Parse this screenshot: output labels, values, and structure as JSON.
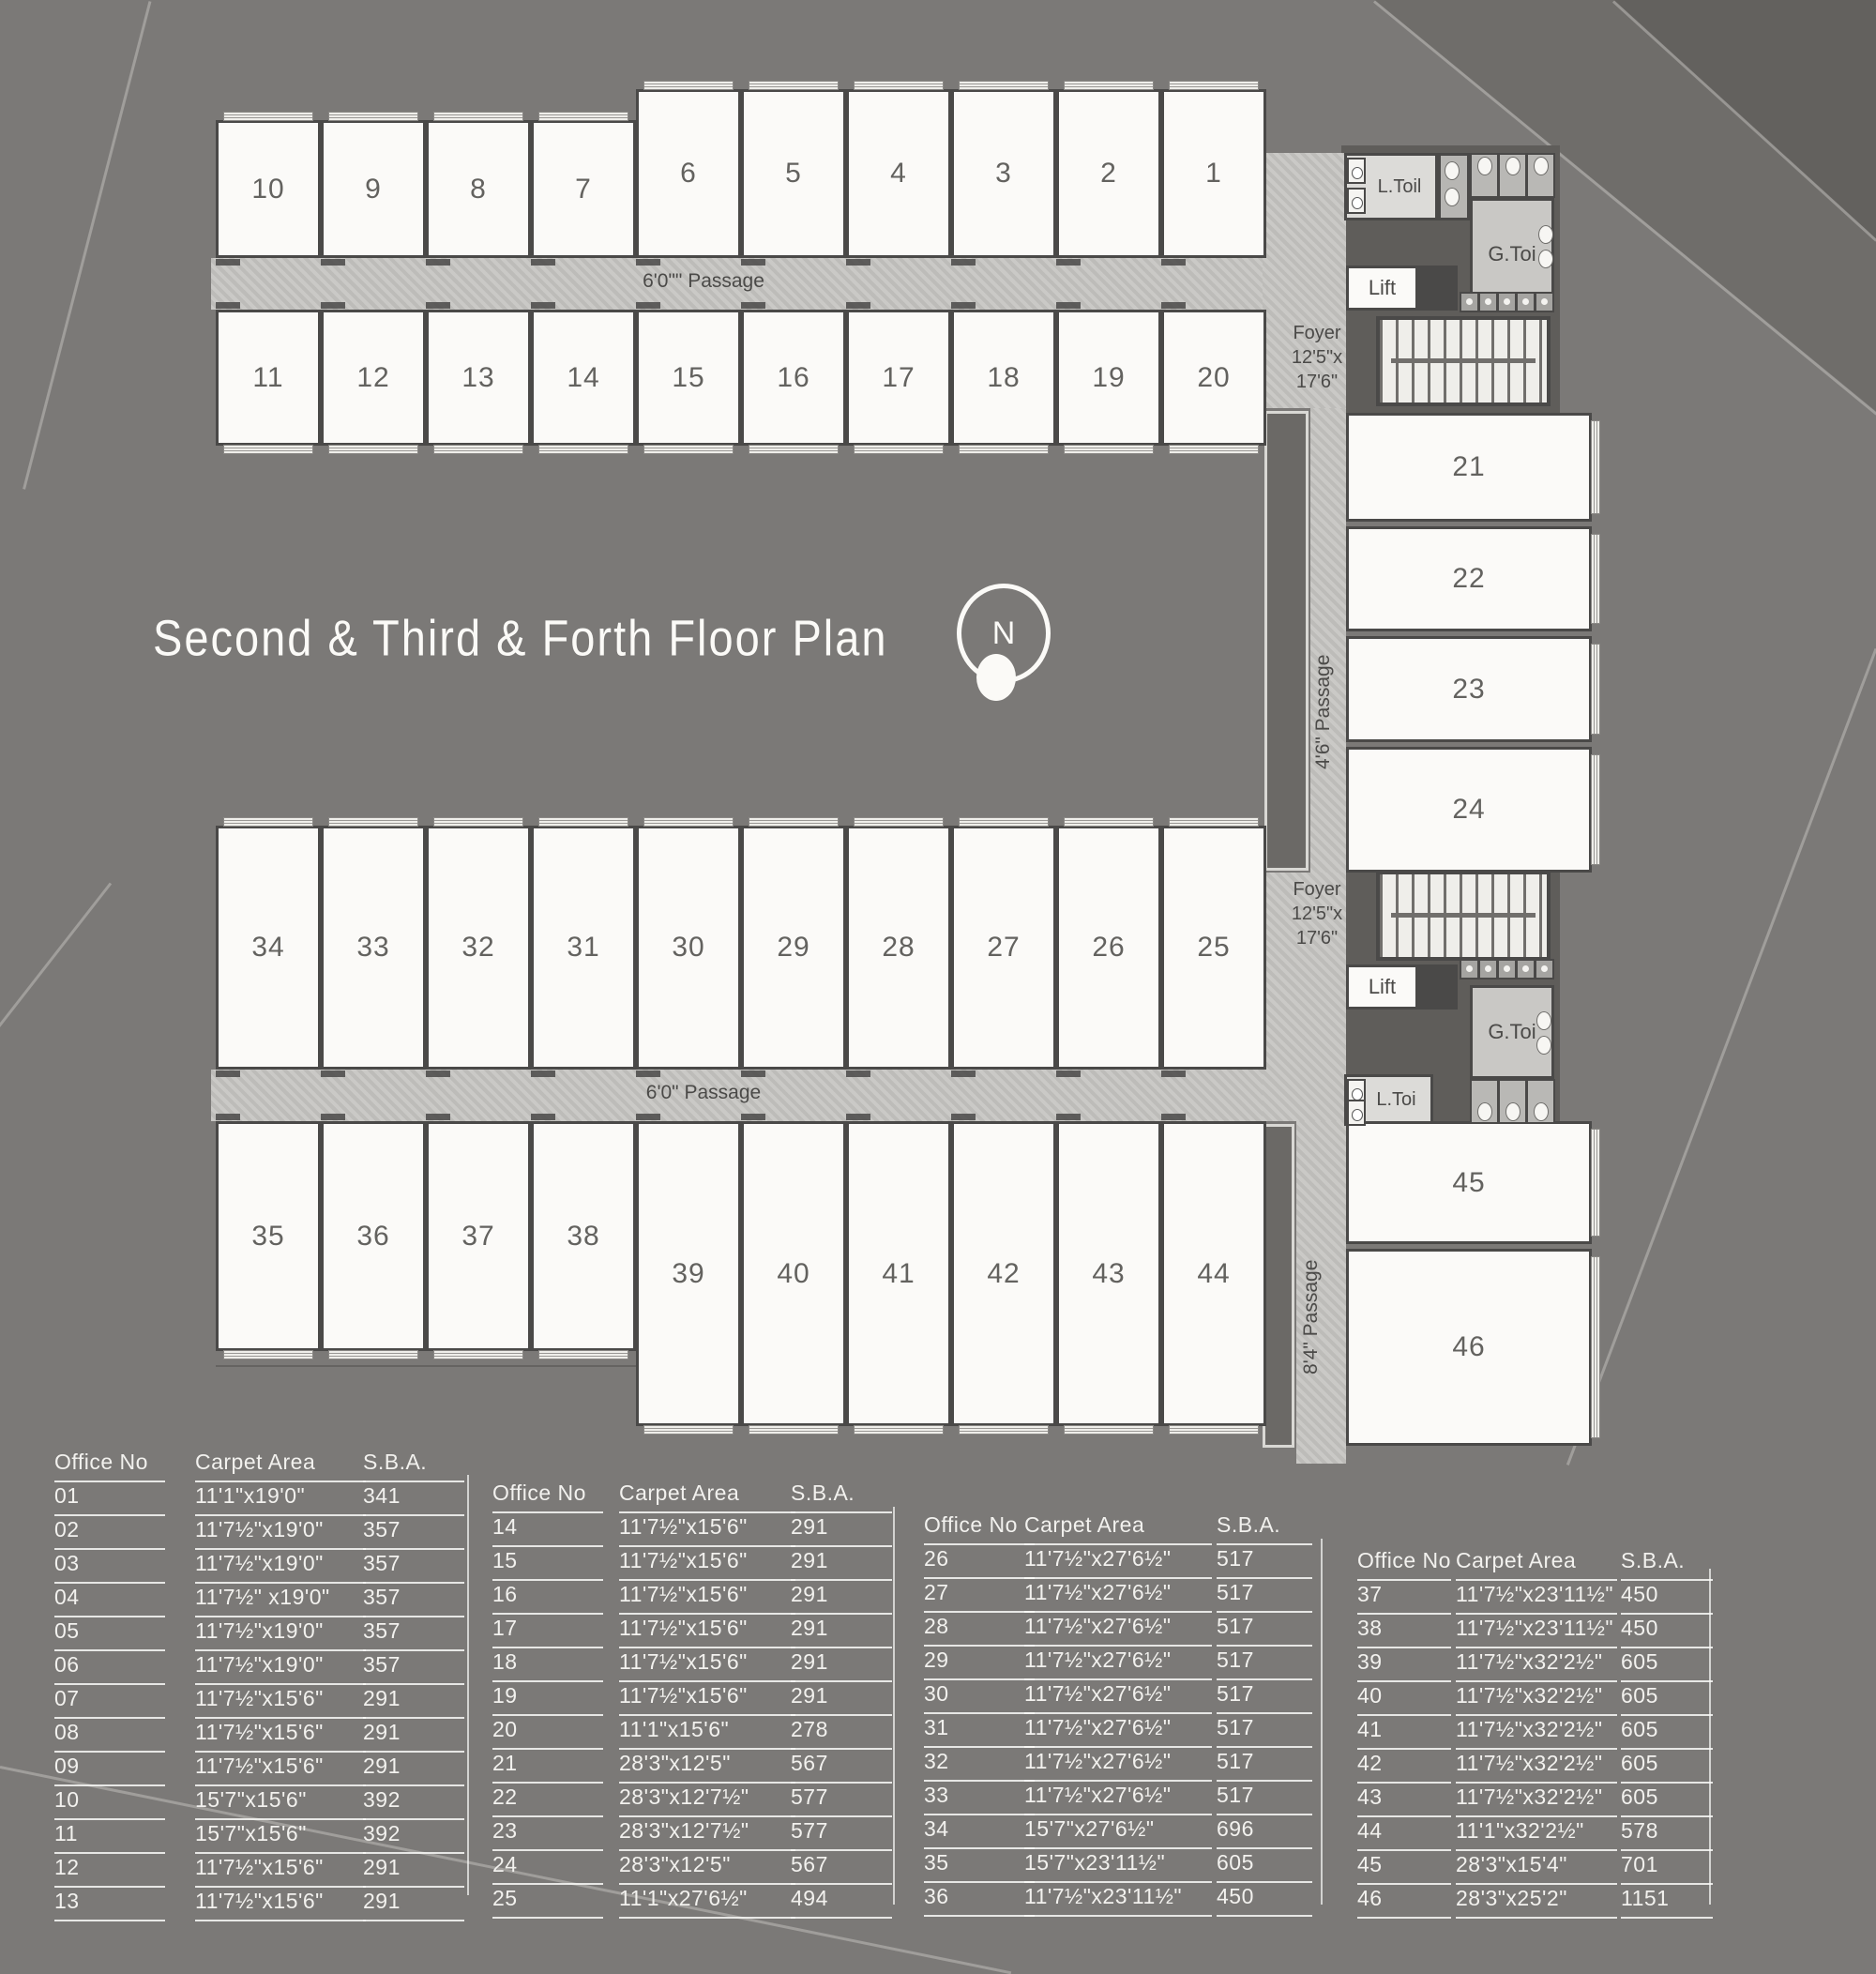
{
  "title": "Second & Third & Forth Floor Plan",
  "compass": {
    "letter": "N"
  },
  "plan": {
    "units": {
      "row_top_a": [
        "10",
        "9",
        "8",
        "7",
        "6",
        "5",
        "4",
        "3",
        "2",
        "1"
      ],
      "row_top_b": [
        "11",
        "12",
        "13",
        "14",
        "15",
        "16",
        "17",
        "18",
        "19",
        "20"
      ],
      "col_right_top": [
        "21",
        "22",
        "23",
        "24"
      ],
      "row_mid_a": [
        "34",
        "33",
        "32",
        "31",
        "30",
        "29",
        "28",
        "27",
        "26",
        "25"
      ],
      "row_mid_b": [
        "35",
        "36",
        "37",
        "38",
        "39",
        "40",
        "41",
        "42",
        "43",
        "44"
      ],
      "col_right_bottom": [
        "45",
        "46"
      ]
    },
    "passages": {
      "top": "6'0\"\" Passage",
      "middle": "6'0\" Passage",
      "right_upper": "4'6\" Passage",
      "right_lower": "8'4\" Passage"
    },
    "foyer_top": {
      "line1": "Foyer",
      "line2": "12'5\"x",
      "line3": "17'6\""
    },
    "foyer_mid": {
      "line1": "Foyer",
      "line2": "12'5\"x",
      "line3": "17'6\""
    },
    "rooms": {
      "ladies_toilet_top": "L.Toil",
      "gents_toilet_top": "G.Toi",
      "lift_top": "Lift",
      "lift_mid": "Lift",
      "gents_toilet_mid": "G.Toi",
      "ladies_toilet_mid": "L.Toi"
    }
  },
  "tables": [
    {
      "headers": [
        "Office No",
        "Carpet Area",
        "S.B.A."
      ],
      "rows": [
        [
          "01",
          "11'1\"x19'0\"",
          "341"
        ],
        [
          "02",
          "11'7½\"x19'0\"",
          "357"
        ],
        [
          "03",
          "11'7½\"x19'0\"",
          "357"
        ],
        [
          "04",
          "11'7½\" x19'0\"",
          "357"
        ],
        [
          "05",
          "11'7½\"x19'0\"",
          "357"
        ],
        [
          "06",
          "11'7½\"x19'0\"",
          "357"
        ],
        [
          "07",
          "11'7½\"x15'6\"",
          "291"
        ],
        [
          "08",
          "11'7½\"x15'6\"",
          "291"
        ],
        [
          "09",
          "11'7½\"x15'6\"",
          "291"
        ],
        [
          "10",
          "15'7\"x15'6\"",
          "392"
        ],
        [
          "11",
          "15'7\"x15'6\"",
          "392"
        ],
        [
          "12",
          "11'7½\"x15'6\"",
          "291"
        ],
        [
          "13",
          "11'7½\"x15'6\"",
          "291"
        ]
      ]
    },
    {
      "headers": [
        "Office No",
        "Carpet Area",
        "S.B.A."
      ],
      "rows": [
        [
          "14",
          "11'7½\"x15'6\"",
          "291"
        ],
        [
          "15",
          "11'7½\"x15'6\"",
          "291"
        ],
        [
          "16",
          "11'7½\"x15'6\"",
          "291"
        ],
        [
          "17",
          "11'7½\"x15'6\"",
          "291"
        ],
        [
          "18",
          "11'7½\"x15'6\"",
          "291"
        ],
        [
          "19",
          "11'7½\"x15'6\"",
          "291"
        ],
        [
          "20",
          "11'1\"x15'6\"",
          "278"
        ],
        [
          "21",
          "28'3\"x12'5\"",
          "567"
        ],
        [
          "22",
          "28'3\"x12'7½\"",
          "577"
        ],
        [
          "23",
          "28'3\"x12'7½\"",
          "577"
        ],
        [
          "24",
          "28'3\"x12'5\"",
          "567"
        ],
        [
          "25",
          "11'1\"x27'6½\"",
          "494"
        ]
      ]
    },
    {
      "headers": [
        "Office No",
        "Carpet Area",
        "S.B.A."
      ],
      "rows": [
        [
          "26",
          "11'7½\"x27'6½\"",
          "517"
        ],
        [
          "27",
          "11'7½\"x27'6½\"",
          "517"
        ],
        [
          "28",
          "11'7½\"x27'6½\"",
          "517"
        ],
        [
          "29",
          "11'7½\"x27'6½\"",
          "517"
        ],
        [
          "30",
          "11'7½\"x27'6½\"",
          "517"
        ],
        [
          "31",
          "11'7½\"x27'6½\"",
          "517"
        ],
        [
          "32",
          "11'7½\"x27'6½\"",
          "517"
        ],
        [
          "33",
          "11'7½\"x27'6½\"",
          "517"
        ],
        [
          "34",
          "15'7\"x27'6½\"",
          "696"
        ],
        [
          "35",
          "15'7\"x23'11½\"",
          "605"
        ],
        [
          "36",
          "11'7½\"x23'11½\"",
          "450"
        ]
      ]
    },
    {
      "headers": [
        "Office No",
        "Carpet Area",
        "S.B.A."
      ],
      "rows": [
        [
          "37",
          "11'7½\"x23'11½\"",
          "450"
        ],
        [
          "38",
          "11'7½\"x23'11½\"",
          "450"
        ],
        [
          "39",
          "11'7½\"x32'2½\"",
          "605"
        ],
        [
          "40",
          "11'7½\"x32'2½\"",
          "605"
        ],
        [
          "41",
          "11'7½\"x32'2½\"",
          "605"
        ],
        [
          "42",
          "11'7½\"x32'2½\"",
          "605"
        ],
        [
          "43",
          "11'7½\"x32'2½\"",
          "605"
        ],
        [
          "44",
          "11'1\"x32'2½\"",
          "578"
        ],
        [
          "45",
          "28'3\"x15'4\"",
          "701"
        ],
        [
          "46",
          "28'3\"x25'2\"",
          "1151"
        ]
      ]
    }
  ]
}
